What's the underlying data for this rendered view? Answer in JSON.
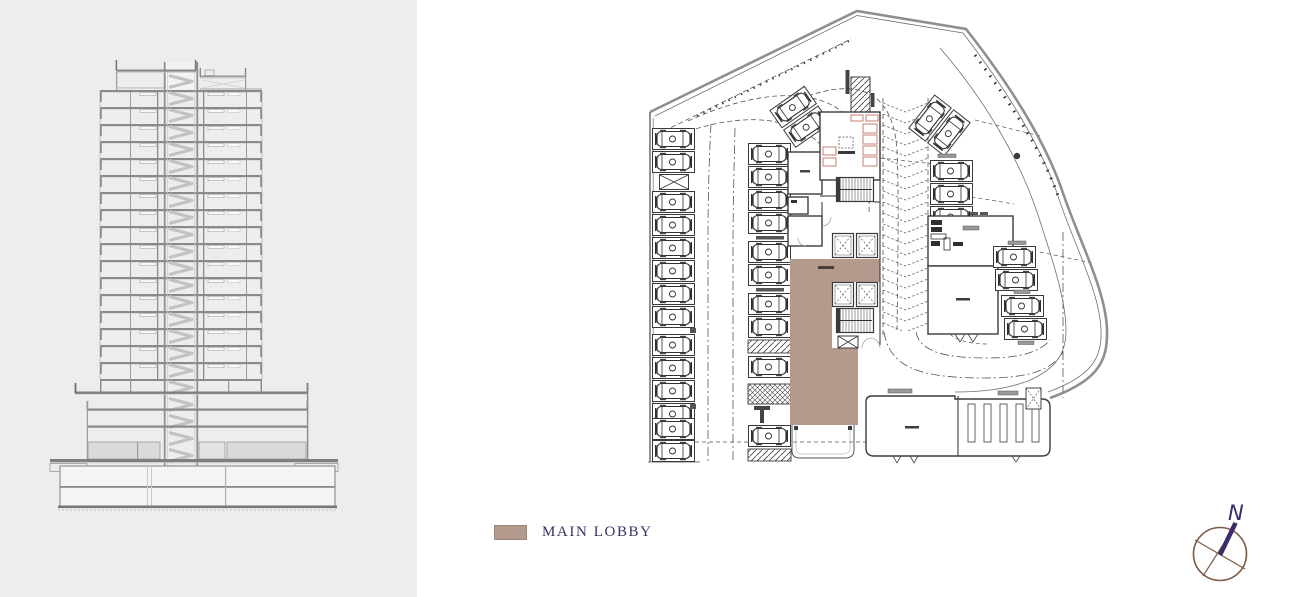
{
  "artboard": {
    "width": 1308,
    "height": 597,
    "background": "#ffffff",
    "panel_background": "#ededee"
  },
  "legend": {
    "items": [
      {
        "label": "MAIN LOBBY",
        "swatch_color": "#b39a8c"
      }
    ],
    "text_color": "#3a3063"
  },
  "compass": {
    "north_label": "N",
    "needle_color": "#3b2b68",
    "ring_color": "#7d5b45"
  },
  "plan_colors": {
    "main_lobby_fill": "#b39a8c",
    "wall_line": "#3c3c3c",
    "boundary_line": "#8f8f8f"
  }
}
